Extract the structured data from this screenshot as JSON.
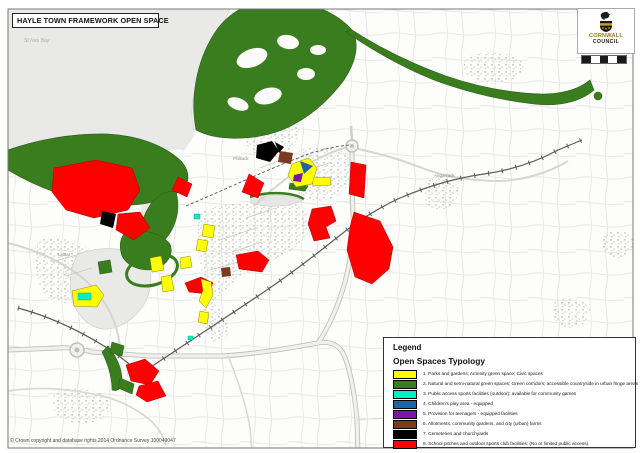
{
  "title": "HAYLE TOWN FRAMEWORK OPEN SPACE",
  "logo": {
    "org_line1": "CORNWALL",
    "org_line2": "COUNCIL",
    "gold": "#9c7a14"
  },
  "copyright": "© Crown copyright and database rights 2014 Ordnance Survey 100049047",
  "legend": {
    "heading": "Legend",
    "subheading": "Open Spaces Typology",
    "items": [
      {
        "label": "1. Parks and gardens; Amenity green space; Civic spaces",
        "color": "#FFFF00"
      },
      {
        "label": "2. Natural and semi-natural green spaces; Green corridors; accessible countryside in urban fringe areas",
        "color": "#3A7D1E"
      },
      {
        "label": "3. Public access sports facilities (outdoor): available for community games",
        "color": "#00EFC1"
      },
      {
        "label": "4. Children's play area - equipped",
        "color": "#2063A5"
      },
      {
        "label": "5. Provision for teenagers - equipped facilities",
        "color": "#7B17A5"
      },
      {
        "label": "6. Allotments, community gardens, and city (urban) farms",
        "color": "#7C3A21"
      },
      {
        "label": "7. Cemeteries and churchyards",
        "color": "#000000"
      },
      {
        "label": "8. School pitches and outdoor sports club facilities: (No or limited public access)",
        "color": "#FF0000"
      }
    ]
  },
  "map_labels": [
    {
      "text": "St Ives Bay"
    },
    {
      "text": "Phillack"
    },
    {
      "text": "Lelant"
    },
    {
      "text": "Angarrack"
    }
  ]
}
